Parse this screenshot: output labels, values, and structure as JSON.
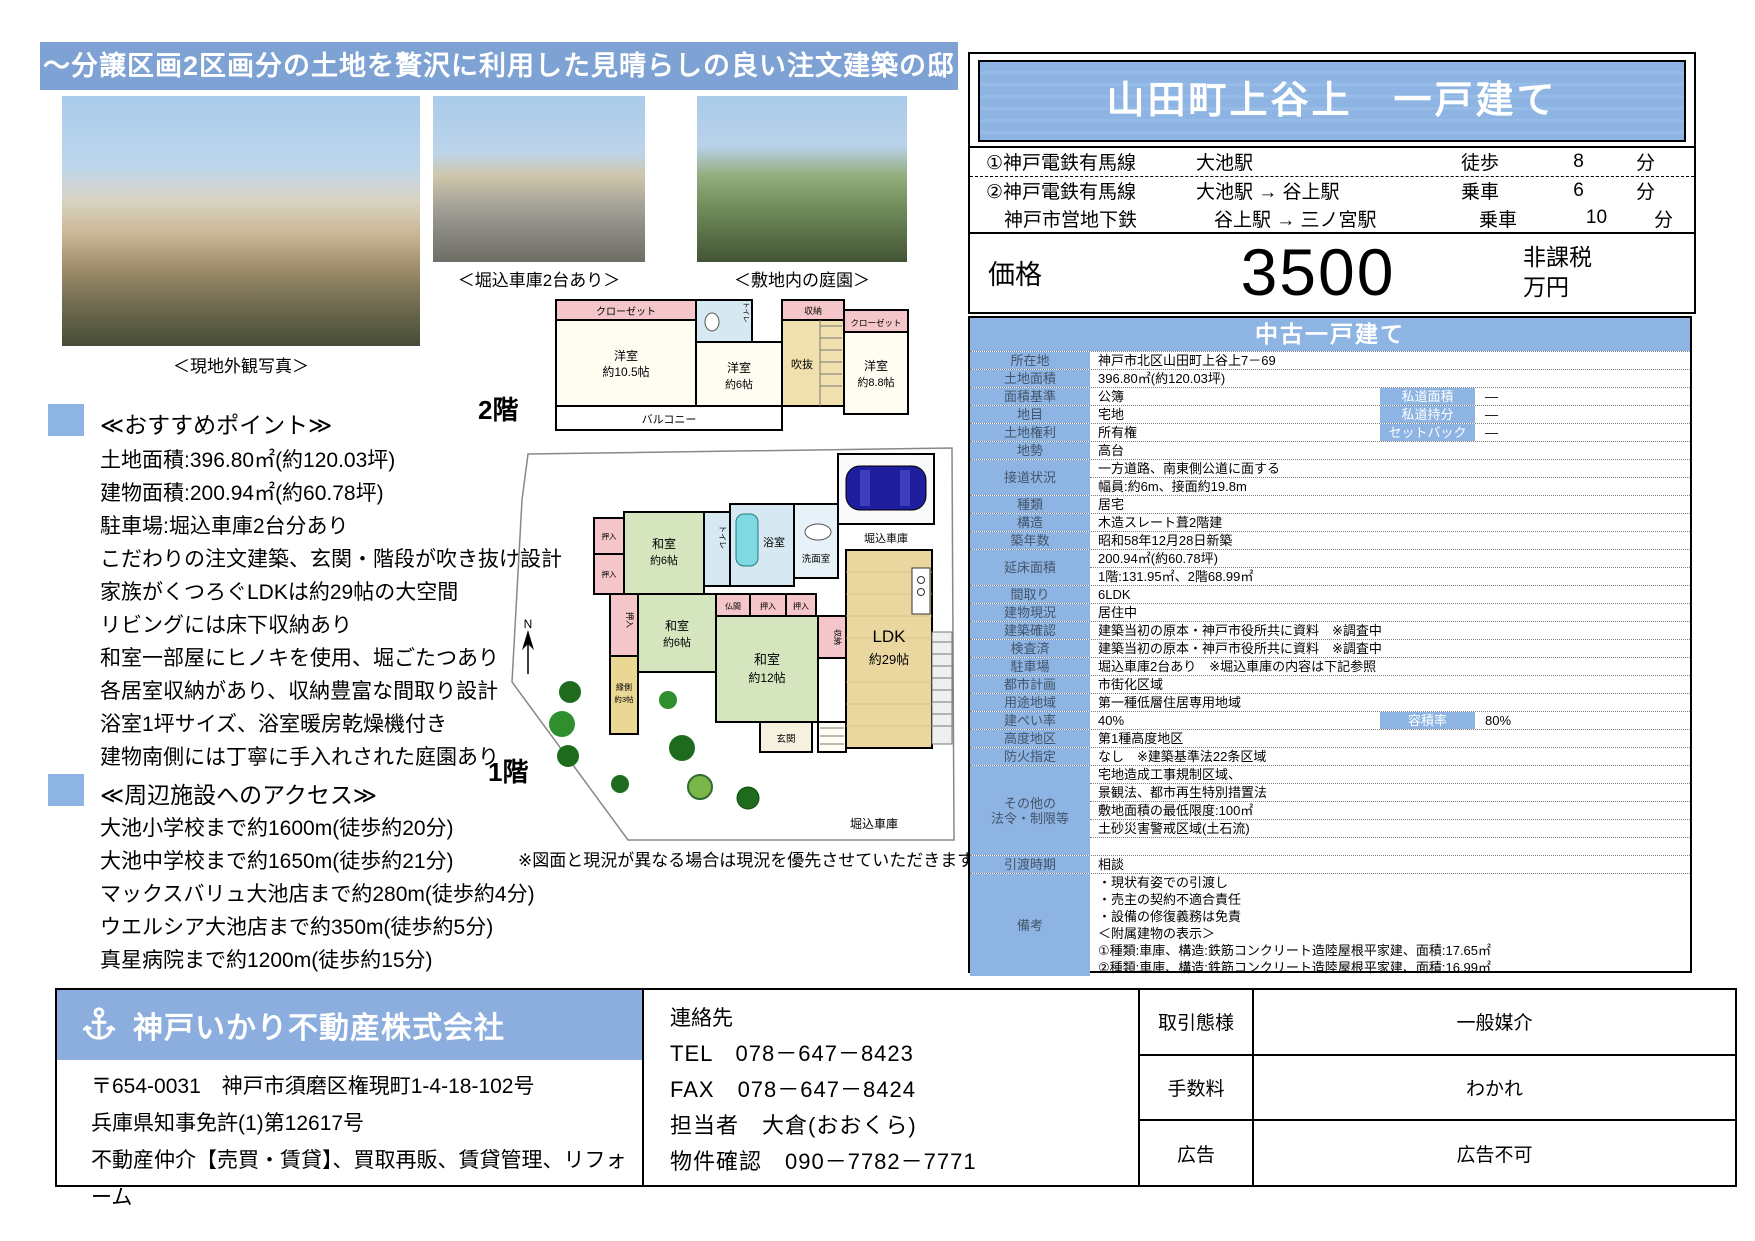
{
  "colors": {
    "banner_blue": "#7da2d3",
    "cell_blue": "#8db4e2",
    "label_text": "#44546a",
    "car_blue": "#1d1d9e"
  },
  "banner": {
    "title": "～分譲区画2区画分の土地を贅沢に利用した見晴らしの良い注文建築の邸宅～"
  },
  "photos": {
    "exterior_caption": "＜現地外観写真＞",
    "garage_caption": "＜堀込車庫2台あり＞",
    "garden_caption": "＜敷地内の庭園＞"
  },
  "recommend": {
    "heading": "≪おすすめポイント≫",
    "items": [
      "土地面積:396.80㎡(約120.03坪)",
      "建物面積:200.94㎡(約60.78坪)",
      "駐車場:堀込車庫2台分あり",
      "こだわりの注文建築、玄関・階段が吹き抜け設計",
      "家族がくつろぐLDKは約29帖の大空間",
      "リビングには床下収納あり",
      "和室一部屋にヒノキを使用、堀ごたつあり",
      "各居室収納があり、収納豊富な間取り設計",
      "浴室1坪サイズ、浴室暖房乾燥機付き",
      "建物南側には丁寧に手入れされた庭園あり"
    ]
  },
  "nearby": {
    "heading": "≪周辺施設へのアクセス≫",
    "items": [
      "大池小学校まで約1600m(徒歩約20分)",
      "大池中学校まで約1650m(徒歩約21分)",
      "マックスバリュ大池店まで約280m(徒歩約4分)",
      "ウエルシア大池店まで約350m(徒歩約5分)",
      "真星病院まで約1200m(徒歩約15分)"
    ]
  },
  "plan": {
    "floor2_label": "2階",
    "floor1_label": "1階",
    "note": "※図面と現況が異なる場合は現況を優先させていただきます。",
    "f2": {
      "closet_l": "クローゼット",
      "room1a": "洋室",
      "room1b": "約10.5帖",
      "toilet": "トイレ",
      "room2a": "洋室",
      "room2b": "約6帖",
      "void": "吹抜",
      "storage": "収納",
      "closet_r": "クローゼット",
      "room3a": "洋室",
      "room3b": "約8.8帖",
      "balcony": "バルコニー"
    },
    "f1": {
      "oshiire1": "押入",
      "oshiire2": "押入",
      "oshiire3": "押入",
      "oshiire4": "押入",
      "oshiire5": "押入",
      "washitsu_a1": "和室",
      "washitsu_a2": "約6帖",
      "washitsu_b1": "和室",
      "washitsu_b2": "約6帖",
      "washitsu_c1": "和室",
      "washitsu_c2": "約12帖",
      "engawa1": "縁側",
      "engawa2": "約3帖",
      "toilet": "トイレ",
      "bath": "浴室",
      "wash": "洗面室",
      "butsuma": "仏間",
      "storage": "収納",
      "ldk1": "LDK",
      "ldk2": "約29帖",
      "genkan": "玄関",
      "garage_top": "堀込車庫",
      "garage_bottom": "堀込車庫",
      "compass": "N"
    }
  },
  "property": {
    "title": "山田町上谷上　一戸建て",
    "access": [
      {
        "line": "①神戸電鉄有馬線",
        "route": "大池駅",
        "mode": "徒歩",
        "minutes": "8",
        "unit": "分"
      },
      {
        "line": "②神戸電鉄有馬線",
        "route": "大池駅 → 谷上駅",
        "mode": "乗車",
        "minutes": "6",
        "unit": "分"
      },
      {
        "line": "神戸市営地下鉄",
        "route": "谷上駅 → 三ノ宮駅",
        "mode": "乗車",
        "minutes": "10",
        "unit": "分"
      }
    ],
    "price_label": "価格",
    "price_value": "3500",
    "price_tax": "非課税",
    "price_unit": "万円",
    "category": "中古一戸建て",
    "rows": {
      "shozaichi": {
        "label": "所在地",
        "value": "神戸市北区山田町上谷上7－69"
      },
      "tochimenseki": {
        "label": "土地面積",
        "value": "396.80㎡(約120.03坪)"
      },
      "mensekikijun": {
        "label": "面積基準",
        "value": "公簿",
        "sub_label": "私道面積",
        "sub_value": "―"
      },
      "chimoku": {
        "label": "地目",
        "value": "宅地",
        "sub_label": "私道持分",
        "sub_value": "―"
      },
      "tochikenri": {
        "label": "土地権利",
        "value": "所有権",
        "sub_label": "セットバック",
        "sub_value": "―"
      },
      "chisei": {
        "label": "地勢",
        "value": "高台"
      },
      "setsudo": {
        "label": "接道状況",
        "line1": "一方道路、南東側公道に面する",
        "line2": "幅員:約6m、接面約19.8m"
      },
      "shurui": {
        "label": "種類",
        "value": "居宅"
      },
      "kozo": {
        "label": "構造",
        "value": "木造スレート葺2階建"
      },
      "chikunen": {
        "label": "築年数",
        "value": "昭和58年12月28日新築"
      },
      "nobeyuka": {
        "label": "延床面積",
        "line1": "200.94㎡(約60.78坪)",
        "line2": "1階:131.95㎡、2階68.99㎡"
      },
      "madori": {
        "label": "間取り",
        "value": "6LDK"
      },
      "genkyo": {
        "label": "建物現況",
        "value": "居住中"
      },
      "kakunin": {
        "label": "建築確認",
        "value": "建築当初の原本・神戸市役所共に資料　※調査中"
      },
      "kensazumi": {
        "label": "検査済",
        "value": "建築当初の原本・神戸市役所共に資料　※調査中"
      },
      "chushajo": {
        "label": "駐車場",
        "value": "堀込車庫2台あり　※堀込車庫の内容は下記参照"
      },
      "toshikeikaku": {
        "label": "都市計画",
        "value": "市街化区域"
      },
      "yotochiiki": {
        "label": "用途地域",
        "value": "第一種低層住居専用地域"
      },
      "kenpei": {
        "label": "建ぺい率",
        "value": "40%",
        "sub_label": "容積率",
        "sub_value": "80%"
      },
      "kodochiku": {
        "label": "高度地区",
        "value": "第1種高度地区"
      },
      "boka": {
        "label": "防火指定",
        "value": "なし　※建築基準法22条区域"
      },
      "sonota": {
        "label": "その他の\n法令・制限等",
        "line1": "宅地造成工事規制区域、",
        "line2": "景観法、都市再生特別措置法",
        "line3": "敷地面積の最低限度:100㎡",
        "line4": "土砂災害警戒区域(土石流)"
      },
      "hikiwatashi": {
        "label": "引渡時期",
        "value": "相談"
      },
      "biko": {
        "label": "備考",
        "lines": [
          "・現状有姿での引渡し",
          "・売主の契約不適合責任",
          "・設備の修復義務は免責",
          "＜附属建物の表示＞",
          "①種類:車庫、構造:鉄筋コンクリート造陸屋根平家建、面積:17.65㎡",
          "②種類:車庫、構造:鉄筋コンクリート造陸屋根平家建、面積:16.99㎡"
        ]
      }
    }
  },
  "company": {
    "name": "神戸いかり不動産株式会社",
    "address": "〒654-0031　神戸市須磨区権現町1-4-18-102号",
    "license": "兵庫県知事免許(1)第12617号",
    "services": "不動産仲介【売買・賃貸】、買取再販、賃貸管理、リフォーム"
  },
  "contact": {
    "heading": "連絡先",
    "tel": "TEL　078－647－8423",
    "fax": "FAX　078－647－8424",
    "person": "担当者　大倉(おおくら)",
    "confirm": "物件確認　090－7782－7771"
  },
  "deal": {
    "rows": [
      {
        "label": "取引態様",
        "value": "一般媒介"
      },
      {
        "label": "手数料",
        "value": "わかれ"
      },
      {
        "label": "広告",
        "value": "広告不可"
      }
    ]
  }
}
